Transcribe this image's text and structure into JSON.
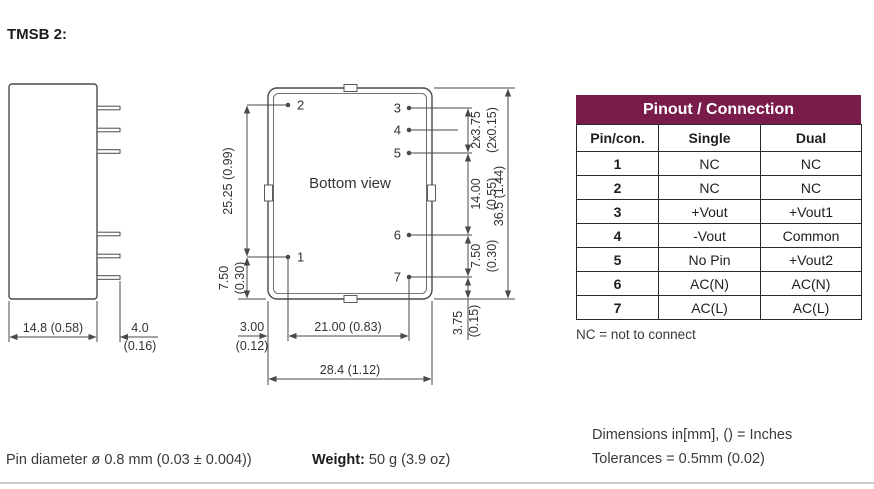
{
  "title": "TMSB 2:",
  "colors": {
    "accent": "#7A1C4B",
    "line": "#4a4a4a",
    "ink": "#333333",
    "rule": "#cccccc"
  },
  "side_view": {
    "dim_width": "14.8 (0.58)",
    "dim_pin_mm": "4.0",
    "dim_pin_in": "(0.16)"
  },
  "bottom_view": {
    "label": "Bottom view",
    "pin_labels": {
      "p1": "1",
      "p2": "2",
      "p3": "3",
      "p4": "4",
      "p5": "5",
      "p6": "6",
      "p7": "7"
    },
    "dims": {
      "left_span": "25.25 (0.99)",
      "left_small_mm": "7.50",
      "left_small_in": "(0.30)",
      "right_top_mm": "2x3.75",
      "right_top_in": "(2x0.15)",
      "right_mid_mm": "14.00",
      "right_mid_in": "(0.55)",
      "right_low_mm": "7.50",
      "right_low_in": "(0.30)",
      "right_bottom_mm": "3.75",
      "right_bottom_in": "(0.15)",
      "right_total": "36.5 (1.44)",
      "bottom_left_mm": "3.00",
      "bottom_left_in": "(0.12)",
      "bottom_mid": "21.00 (0.83)",
      "bottom_total": "28.4 (1.12)"
    }
  },
  "pinout_table": {
    "title": "Pinout / Connection",
    "headers": [
      "Pin/con.",
      "Single",
      "Dual"
    ],
    "rows": [
      {
        "pin": "1",
        "single": "NC",
        "dual": "NC"
      },
      {
        "pin": "2",
        "single": "NC",
        "dual": "NC"
      },
      {
        "pin": "3",
        "single": "+Vout",
        "dual": "+Vout1"
      },
      {
        "pin": "4",
        "single": "-Vout",
        "dual": "Common"
      },
      {
        "pin": "5",
        "single": "No Pin",
        "dual": "+Vout2"
      },
      {
        "pin": "6",
        "single": "AC(N)",
        "dual": "AC(N)"
      },
      {
        "pin": "7",
        "single": "AC(L)",
        "dual": "AC(L)"
      }
    ],
    "note": "NC = not to connect"
  },
  "footer": {
    "pin_diameter": "Pin diameter ø 0.8 mm (0.03 ± 0.004))",
    "weight_label": "Weight:",
    "weight_value": "50 g (3.9 oz)",
    "dimensions_note": "Dimensions in[mm], () = Inches",
    "tolerances_note": "Tolerances = 0.5mm (0.02)"
  }
}
